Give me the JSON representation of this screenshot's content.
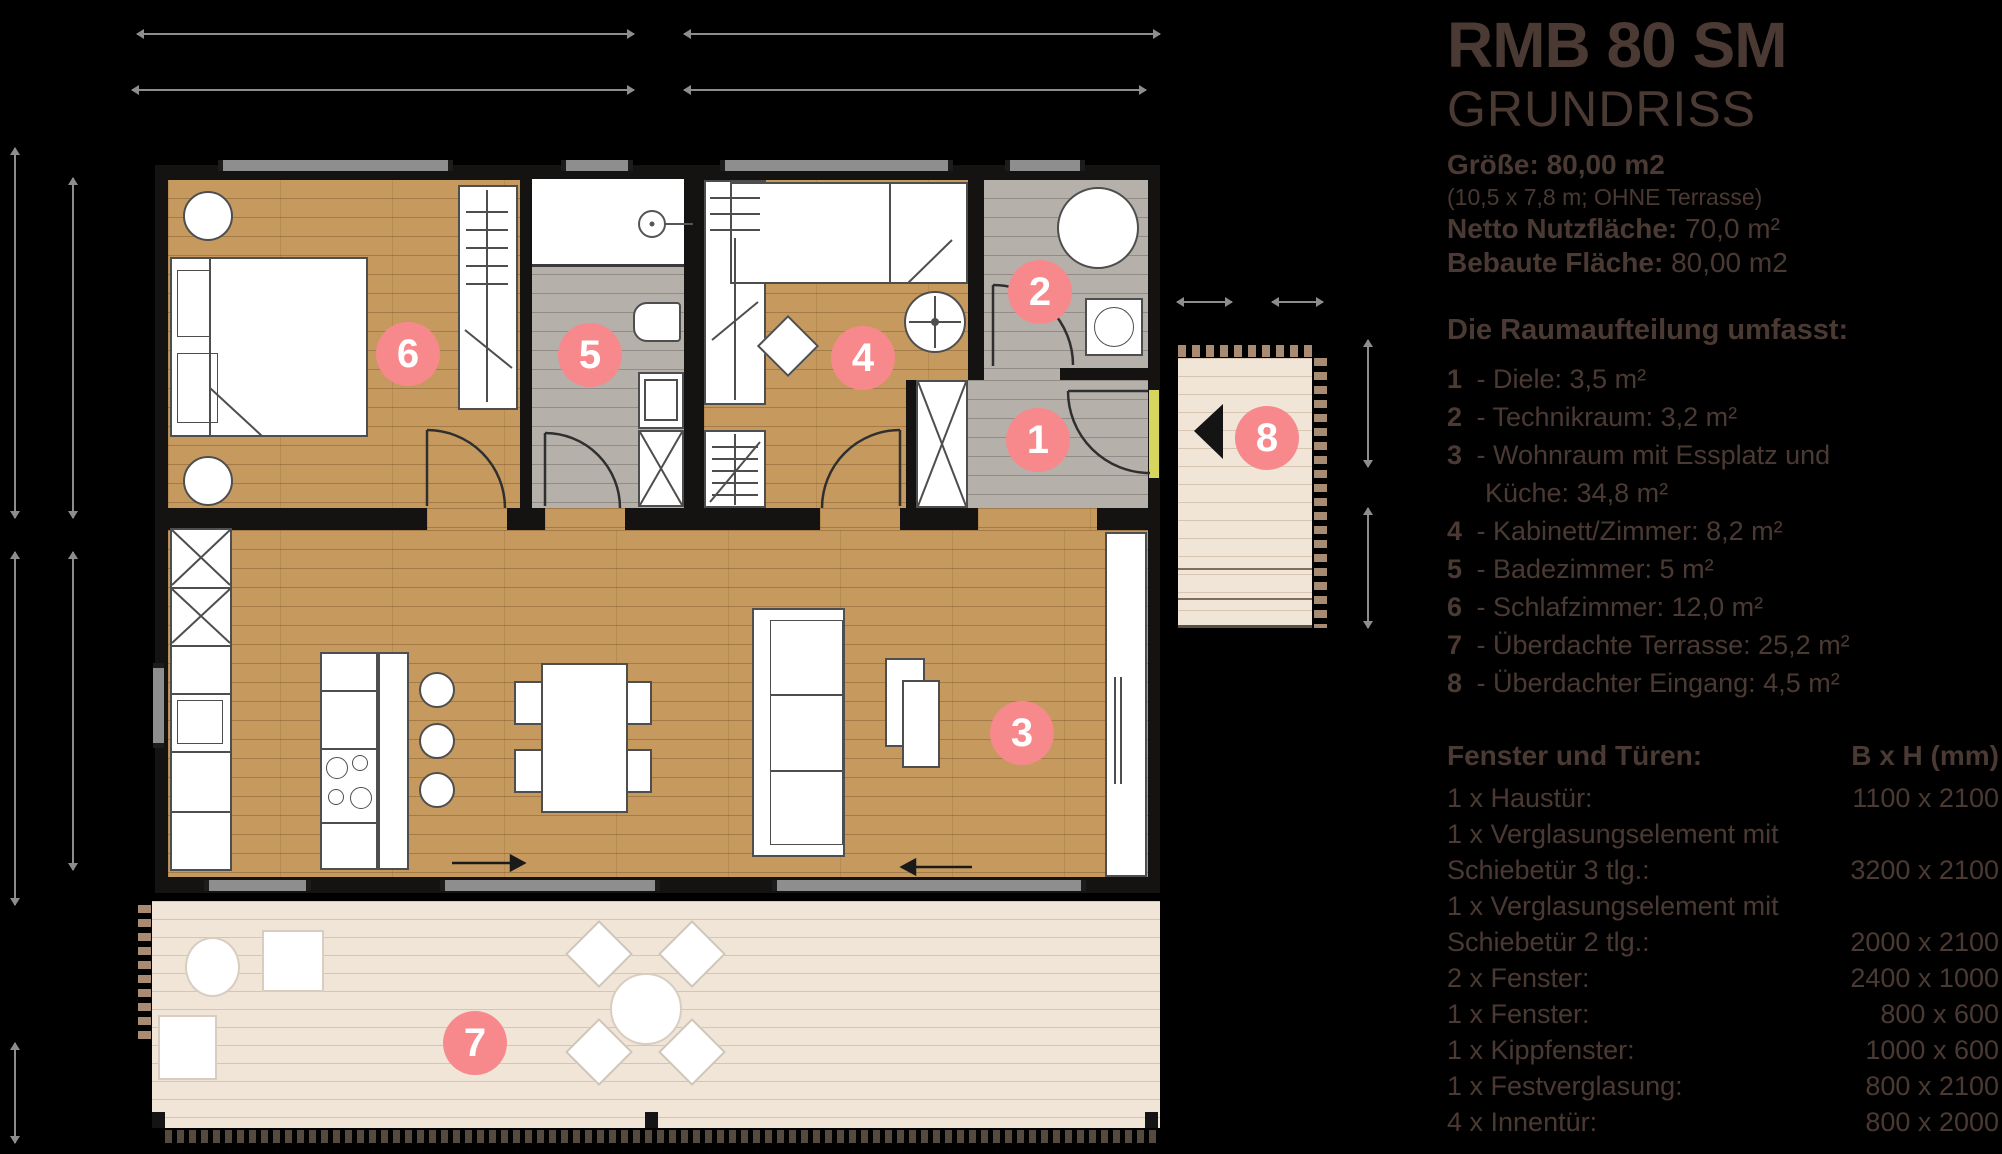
{
  "title": "RMB 80 SM",
  "subtitle": "GRUNDRISS",
  "meta": {
    "size_label": "Größe:",
    "size_value": "80,00 m2",
    "size_note": "(10,5 x 7,8 m; OHNE Terrasse)",
    "net_label": "Netto Nutzfläche:",
    "net_value": "70,0 m²",
    "built_label": "Bebaute Fläche:",
    "built_value": "80,00 m2"
  },
  "rooms_heading": "Die Raumaufteilung umfasst:",
  "rooms": [
    {
      "num": "1",
      "text": "- Diele: 3,5 m²"
    },
    {
      "num": "2",
      "text": "- Technikraum: 3,2 m²"
    },
    {
      "num": "3",
      "text": "- Wohnraum mit Essplatz und",
      "text2": "Küche: 34,8 m²"
    },
    {
      "num": "4",
      "text": "- Kabinett/Zimmer: 8,2 m²"
    },
    {
      "num": "5",
      "text": "- Badezimmer: 5 m²"
    },
    {
      "num": "6",
      "text": "- Schlafzimmer: 12,0 m²"
    },
    {
      "num": "7",
      "text": "- Überdachte Terrasse: 25,2 m²"
    },
    {
      "num": "8",
      "text": "- Überdachter Eingang: 4,5 m²"
    }
  ],
  "windows_heading": "Fenster und Türen:",
  "windows_unit": "B x H (mm)",
  "windows": [
    {
      "label": "1 x Haustür:",
      "value": "1100 x 2100"
    },
    {
      "label": "1 x Verglasungselement mit",
      "value": ""
    },
    {
      "label": "Schiebetür 3 tlg.:",
      "value": "3200 x 2100"
    },
    {
      "label": "1 x Verglasungselement mit",
      "value": ""
    },
    {
      "label": "Schiebetür 2 tlg.:",
      "value": "2000 x 2100"
    },
    {
      "label": "2 x Fenster:",
      "value": "2400 x 1000"
    },
    {
      "label": "1 x Fenster:",
      "value": "800 x 600"
    },
    {
      "label": "1 x Kippfenster:",
      "value": "1000 x 600"
    },
    {
      "label": "1 x Festverglasung:",
      "value": "800 x 2100"
    },
    {
      "label": "4 x Innentür:",
      "value": "800 x 2000"
    }
  ],
  "markers": [
    "1",
    "2",
    "3",
    "4",
    "5",
    "6",
    "7",
    "8"
  ],
  "colors": {
    "background": "#000000",
    "text": "#4b3a33",
    "marker_pink": "#f7898c",
    "wood_floor": "#c69a5e",
    "tile_floor": "#b5b0aa",
    "deck": "#f0e5d7",
    "wall": "#151312",
    "window_sill": "#8e8e8e",
    "entry_door": "#d6d65e"
  }
}
